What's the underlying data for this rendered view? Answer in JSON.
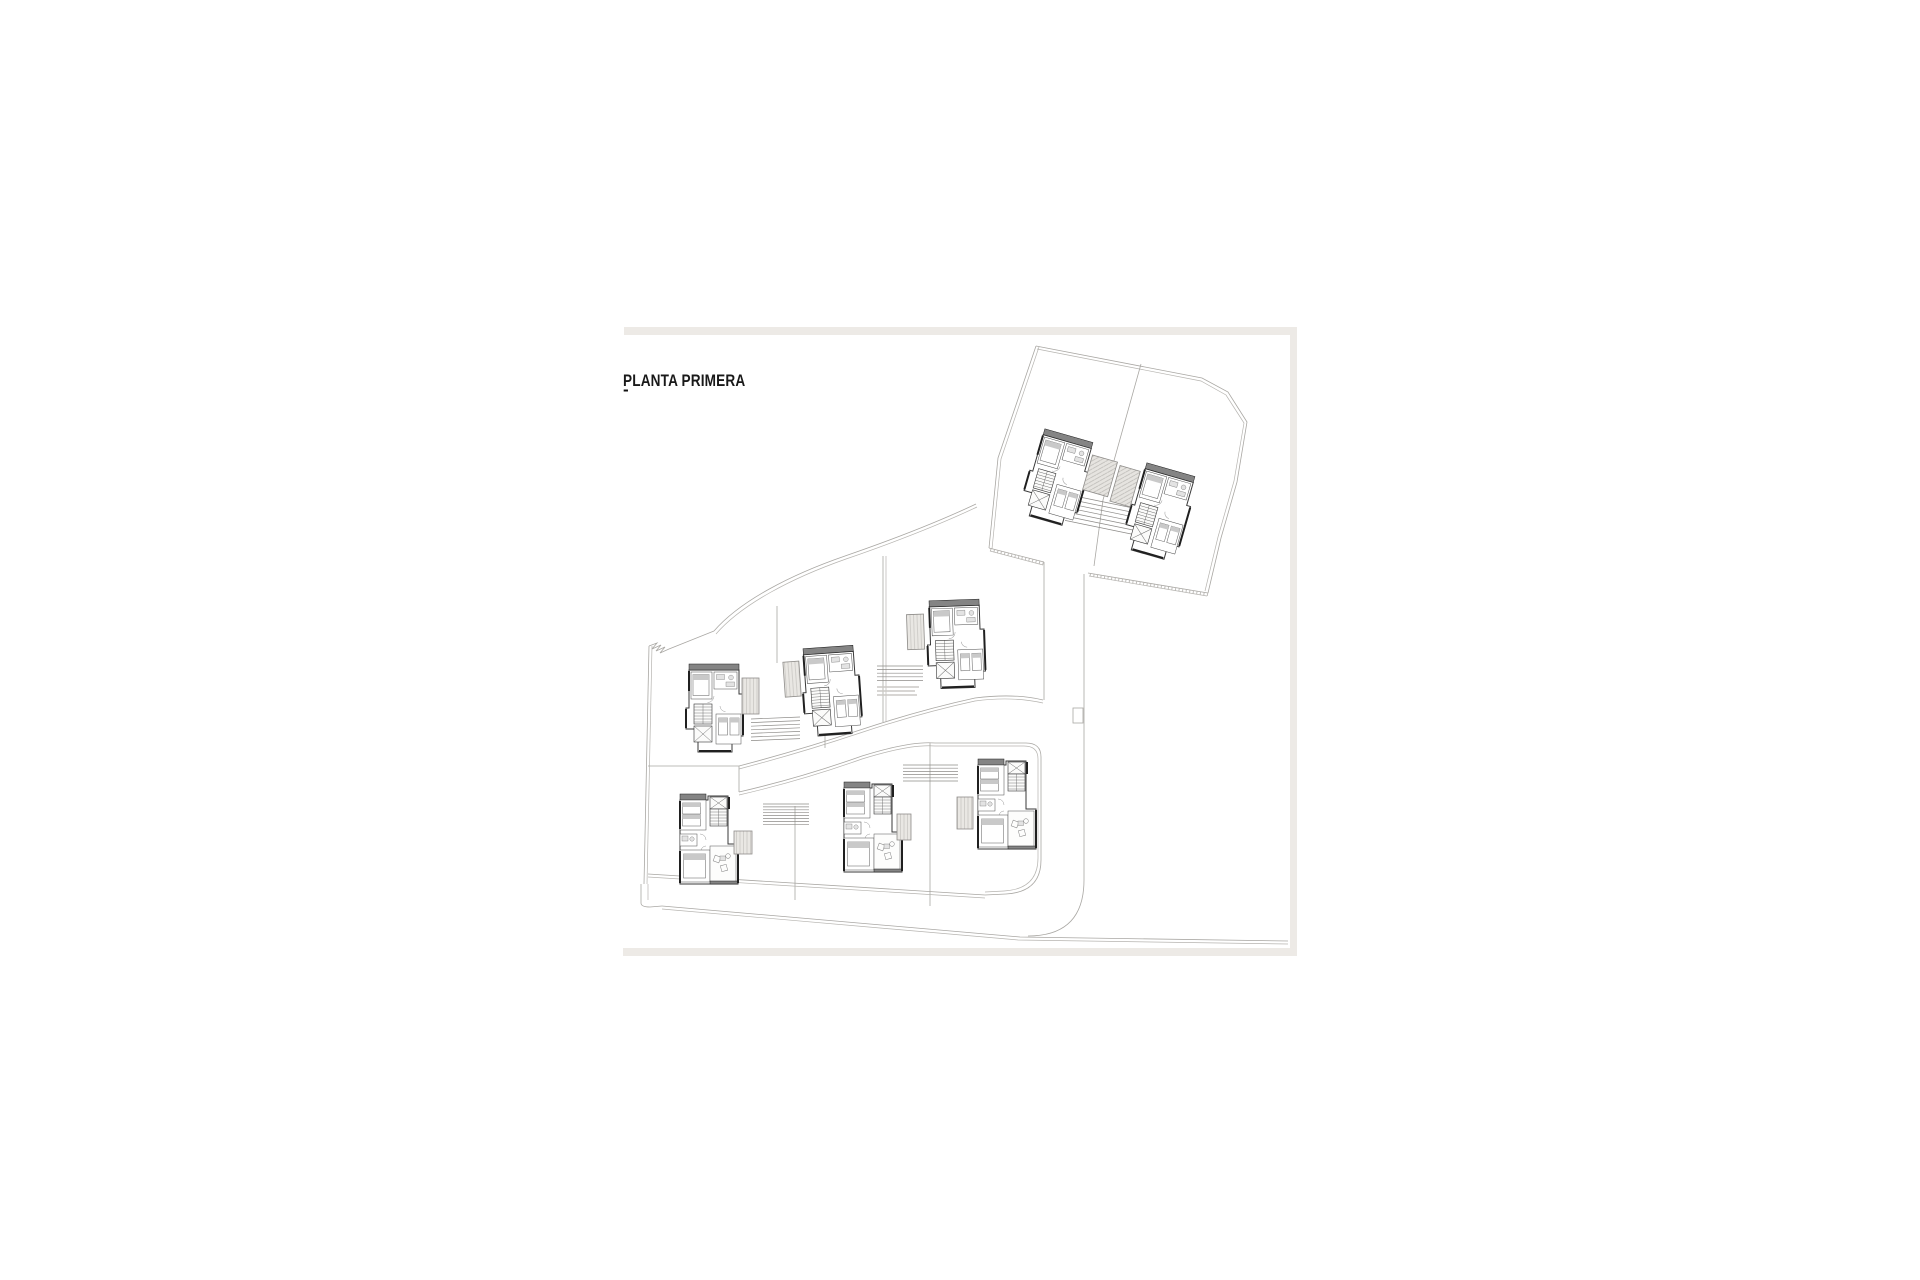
{
  "figure": {
    "title": "PLANTA PRIMERA",
    "title_mark": "-"
  },
  "plan": {
    "label": "site-plan-first-floor-eight-villas",
    "colors": {
      "boundary": "#a9a7a3",
      "wall": "#3a3a3a",
      "roof_strip": "#848484",
      "pergola_fill": "#e9e7e3",
      "pergola_hatch": "#bcbab6",
      "frame": "#edeae6",
      "paper": "#ffffff",
      "title_color": "#191919"
    },
    "villas": [
      {
        "id": "villa-1",
        "variant": "m",
        "x": 1042,
        "y": 428,
        "rot": 16,
        "pergola": {
          "dx": 56,
          "dy": 12,
          "w": 26,
          "h": 36,
          "hatch": "diag"
        }
      },
      {
        "id": "villa-2",
        "variant": "m",
        "x": 1144,
        "y": 462,
        "rot": 16,
        "pergola": {
          "dx": -22,
          "dy": 10,
          "w": 21,
          "h": 37,
          "hatch": "diag"
        }
      },
      {
        "id": "villa-3",
        "variant": "m",
        "x": 686,
        "y": 664,
        "rot": 0,
        "pergola": {
          "dx": 56,
          "dy": 14,
          "w": 17,
          "h": 36,
          "hatch": "vert"
        }
      },
      {
        "id": "villa-4",
        "variant": "m",
        "x": 800,
        "y": 649,
        "rot": -4,
        "pergola": {
          "dx": -18,
          "dy": 12,
          "w": 16,
          "h": 35,
          "hatch": "vert"
        }
      },
      {
        "id": "villa-5",
        "variant": "m",
        "x": 926,
        "y": 601,
        "rot": -2,
        "pergola": {
          "dx": -20,
          "dy": 13,
          "w": 17,
          "h": 35,
          "hatch": "vert"
        }
      },
      {
        "id": "villa-6",
        "variant": "b",
        "x": 676,
        "y": 794,
        "rot": 0,
        "pergola": {
          "dx": 58,
          "dy": 37,
          "w": 18,
          "h": 23,
          "hatch": "vert"
        }
      },
      {
        "id": "villa-7",
        "variant": "b",
        "x": 840,
        "y": 782,
        "rot": 0,
        "pergola": {
          "dx": 57,
          "dy": 32,
          "w": 14,
          "h": 26,
          "hatch": "vert"
        }
      },
      {
        "id": "villa-8",
        "variant": "b",
        "x": 974,
        "y": 759,
        "rot": 0,
        "pergola": {
          "dx": -17,
          "dy": 38,
          "w": 16,
          "h": 32,
          "hatch": "vert"
        }
      }
    ],
    "steps": [
      {
        "id": "steps-1",
        "x": 1065,
        "y": 494,
        "count": 7,
        "len": 68,
        "dy": 4.4,
        "drop": 14
      },
      {
        "id": "steps-2",
        "x": 751,
        "y": 719,
        "count": 7,
        "len": 49,
        "dy": 3.6,
        "drop": -2
      },
      {
        "id": "steps-3",
        "x": 877,
        "y": 666,
        "count": 5,
        "len": 46,
        "dy": 3.6,
        "drop": 0
      },
      {
        "id": "steps-4",
        "x": 763,
        "y": 804,
        "count": 8,
        "len": 46,
        "dy": 2.9,
        "drop": 0
      },
      {
        "id": "steps-5",
        "x": 903,
        "y": 765,
        "count": 6,
        "len": 55,
        "dy": 3.2,
        "drop": 0
      }
    ],
    "annotations": [
      {
        "x": 877,
        "y": 687,
        "len": 42
      },
      {
        "x": 877,
        "y": 691,
        "len": 38
      },
      {
        "x": 877,
        "y": 695,
        "len": 40
      }
    ]
  }
}
